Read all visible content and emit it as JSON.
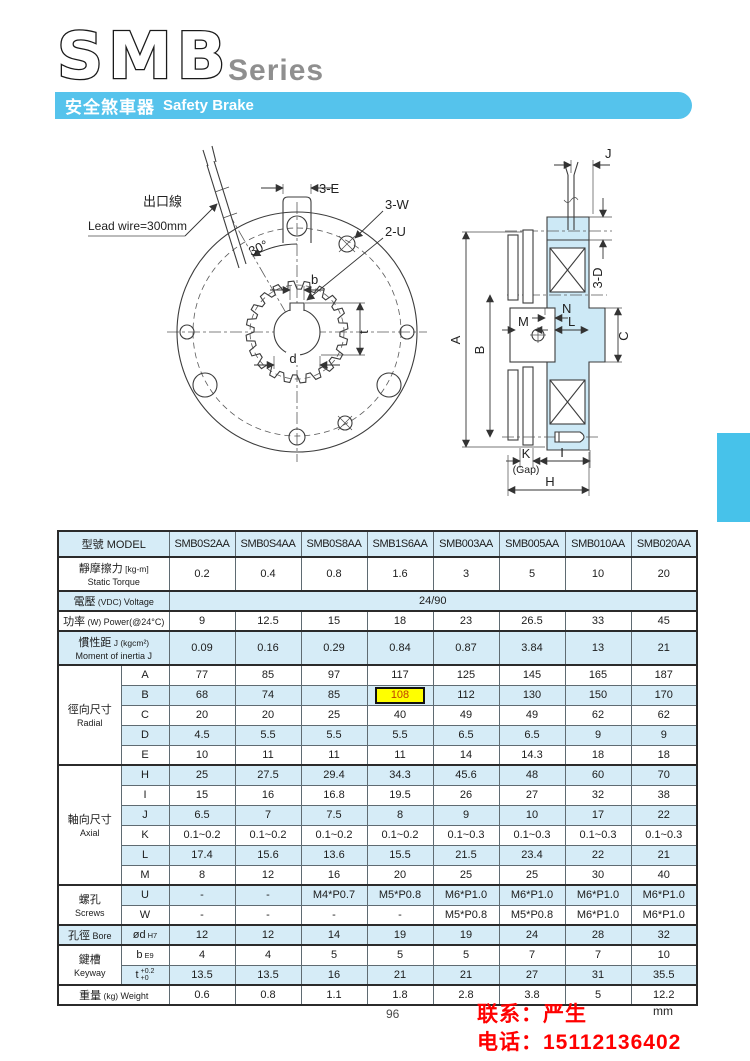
{
  "header": {
    "series_name": "SMB",
    "series_suffix": "Series",
    "banner_zh": "安全煞車器",
    "banner_en": "Safety Brake"
  },
  "colors": {
    "banner_blue": "#55c3ec",
    "table_row_blue": "#d6ecf7",
    "drawing_fill_blue": "#cde9f6",
    "edge_tab_blue": "#47c2ea",
    "highlight_yellow": "#ffff00",
    "highlight_text": "#c04000",
    "contact_red": "#ff0000"
  },
  "drawing": {
    "front": {
      "lead_wire_zh": "出口線",
      "lead_wire_en": "Lead wire=300mm",
      "dim_3e": "3-E",
      "dim_3w": "3-W",
      "dim_2u": "2-U",
      "angle": "30°",
      "dim_b": "b",
      "dim_t": "t",
      "dim_d": "d"
    },
    "side": {
      "dim_j": "J",
      "dim_3d": "3-D",
      "dim_a": "A",
      "dim_b": "B",
      "dim_m": "M",
      "dim_n": "N",
      "dim_l": "L",
      "dim_c": "C",
      "dim_k": "K",
      "gap": "(Gap)",
      "dim_i": "I",
      "dim_h": "H"
    }
  },
  "table": {
    "header": {
      "label_zh": "型號",
      "label_en": "MODEL",
      "models": [
        "SMB0S2AA",
        "SMB0S4AA",
        "SMB0S8AA",
        "SMB1S6AA",
        "SMB003AA",
        "SMB005AA",
        "SMB010AA",
        "SMB020AA"
      ]
    },
    "sections": [
      {
        "type": "row",
        "shade": false,
        "two_line": true,
        "label": {
          "zh": "靜摩擦力",
          "note": "[kg-m]",
          "en": "Static Torque"
        },
        "values": [
          "0.2",
          "0.4",
          "0.8",
          "1.6",
          "3",
          "5",
          "10",
          "20"
        ]
      },
      {
        "type": "span",
        "shade": true,
        "two_line": false,
        "label": {
          "zh": "電壓",
          "note": "(VDC)",
          "en": "Voltage"
        },
        "value": "24/90"
      },
      {
        "type": "row",
        "shade": false,
        "two_line": false,
        "label": {
          "zh": "功率",
          "note": "(W)",
          "en": "Power(@24°C)"
        },
        "values": [
          "9",
          "12.5",
          "15",
          "18",
          "23",
          "26.5",
          "33",
          "45"
        ]
      },
      {
        "type": "row",
        "shade": true,
        "two_line": true,
        "label": {
          "zh": "慣性距",
          "note": "J (kgcm²)",
          "en": "Moment of inertia J"
        },
        "values": [
          "0.09",
          "0.16",
          "0.29",
          "0.84",
          "0.87",
          "3.84",
          "13",
          "21"
        ]
      },
      {
        "type": "group",
        "label": {
          "zh": "徑向尺寸",
          "en": "Radial"
        },
        "rows": [
          {
            "key": {
              "text": "A"
            },
            "shade": false,
            "values": [
              "77",
              "85",
              "97",
              "117",
              "125",
              "145",
              "165",
              "187"
            ]
          },
          {
            "key": {
              "text": "B"
            },
            "shade": true,
            "highlight": 3,
            "values": [
              "68",
              "74",
              "85",
              "108",
              "112",
              "130",
              "150",
              "170"
            ]
          },
          {
            "key": {
              "text": "C"
            },
            "shade": false,
            "values": [
              "20",
              "20",
              "25",
              "40",
              "49",
              "49",
              "62",
              "62"
            ]
          },
          {
            "key": {
              "text": "D"
            },
            "shade": true,
            "values": [
              "4.5",
              "5.5",
              "5.5",
              "5.5",
              "6.5",
              "6.5",
              "9",
              "9"
            ]
          },
          {
            "key": {
              "text": "E"
            },
            "shade": false,
            "values": [
              "10",
              "11",
              "11",
              "11",
              "14",
              "14.3",
              "18",
              "18"
            ]
          }
        ]
      },
      {
        "type": "group",
        "label": {
          "zh": "軸向尺寸",
          "en": "Axial"
        },
        "rows": [
          {
            "key": {
              "text": "H"
            },
            "shade": true,
            "values": [
              "25",
              "27.5",
              "29.4",
              "34.3",
              "45.6",
              "48",
              "60",
              "70"
            ]
          },
          {
            "key": {
              "text": "I"
            },
            "shade": false,
            "values": [
              "15",
              "16",
              "16.8",
              "19.5",
              "26",
              "27",
              "32",
              "38"
            ]
          },
          {
            "key": {
              "text": "J"
            },
            "shade": true,
            "values": [
              "6.5",
              "7",
              "7.5",
              "8",
              "9",
              "10",
              "17",
              "22"
            ]
          },
          {
            "key": {
              "text": "K"
            },
            "shade": false,
            "values": [
              "0.1~0.2",
              "0.1~0.2",
              "0.1~0.2",
              "0.1~0.2",
              "0.1~0.3",
              "0.1~0.3",
              "0.1~0.3",
              "0.1~0.3"
            ]
          },
          {
            "key": {
              "text": "L"
            },
            "shade": true,
            "values": [
              "17.4",
              "15.6",
              "13.6",
              "15.5",
              "21.5",
              "23.4",
              "22",
              "21"
            ]
          },
          {
            "key": {
              "text": "M"
            },
            "shade": false,
            "values": [
              "8",
              "12",
              "16",
              "20",
              "25",
              "25",
              "30",
              "40"
            ]
          }
        ]
      },
      {
        "type": "group",
        "label": {
          "zh": "螺孔",
          "en": "Screws"
        },
        "rows": [
          {
            "key": {
              "text": "U"
            },
            "shade": true,
            "values": [
              "-",
              "-",
              "M4*P0.7",
              "M5*P0.8",
              "M6*P1.0",
              "M6*P1.0",
              "M6*P1.0",
              "M6*P1.0"
            ]
          },
          {
            "key": {
              "text": "W"
            },
            "shade": false,
            "values": [
              "-",
              "-",
              "-",
              "-",
              "M5*P0.8",
              "M5*P0.8",
              "M6*P1.0",
              "M6*P1.0"
            ]
          }
        ]
      },
      {
        "type": "group",
        "label": {
          "zh": "孔徑",
          "en": "Bore"
        },
        "rows": [
          {
            "key": {
              "text": "ød",
              "sub": "H7"
            },
            "shade": true,
            "values": [
              "12",
              "12",
              "14",
              "19",
              "19",
              "24",
              "28",
              "32"
            ]
          }
        ]
      },
      {
        "type": "group",
        "label": {
          "zh": "鍵槽",
          "en": "Keyway"
        },
        "rows": [
          {
            "key": {
              "text": "b",
              "sub": "E9"
            },
            "shade": false,
            "values": [
              "4",
              "4",
              "5",
              "5",
              "5",
              "7",
              "7",
              "10"
            ]
          },
          {
            "key": {
              "text": "t",
              "tol_top": "+0.2",
              "tol_bot": "+0"
            },
            "shade": true,
            "values": [
              "13.5",
              "13.5",
              "16",
              "21",
              "21",
              "27",
              "31",
              "35.5"
            ]
          }
        ]
      },
      {
        "type": "row",
        "shade": false,
        "two_line": false,
        "label": {
          "zh": "重量",
          "note": "(kg)",
          "en": "Weight"
        },
        "values": [
          "0.6",
          "0.8",
          "1.1",
          "1.8",
          "2.8",
          "3.8",
          "5",
          "12.2"
        ]
      }
    ]
  },
  "footer": {
    "page_number": "96",
    "unit": "mm",
    "contact_name": "联系：严生",
    "contact_phone": "电话：15112136402"
  }
}
